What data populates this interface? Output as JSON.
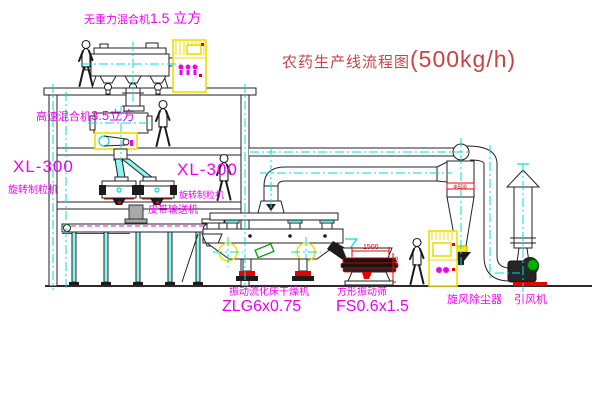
{
  "title": {
    "text": "农药生产线流程图",
    "capacity": "(500kg/h)"
  },
  "machines": {
    "mixer_top": {
      "name": "无重力混合机",
      "spec": "1.5 立方"
    },
    "mixer_mid": {
      "name": "高速混合机",
      "spec": "3.5立方"
    },
    "granulator_left": {
      "model": "XL-300",
      "name": "旋转制粒机"
    },
    "granulator_right": {
      "model": "XL-300",
      "name": "旋转制粒机"
    },
    "belt_conveyor": {
      "name": "皮带输送机"
    },
    "dryer": {
      "name": "振动流化床干燥机",
      "model": "ZLG6x0.75"
    },
    "sieve": {
      "name": "方形振动筛",
      "model": "FS0.6x1.5"
    },
    "cyclone": {
      "name": "旋风除尘器",
      "dia": "Φ500"
    },
    "fan": {
      "name": "引风机"
    }
  },
  "dimensions": {
    "sieve_length": "1500",
    "sieve_height": "545"
  },
  "colors": {
    "label_magenta": "#f000f0",
    "title_red": "#c94343",
    "dim_red": "#ff0000",
    "centerline_cyan": "#00dcdc",
    "cabinet_yellow": "#eedd00",
    "motor_green": "#00a000"
  }
}
